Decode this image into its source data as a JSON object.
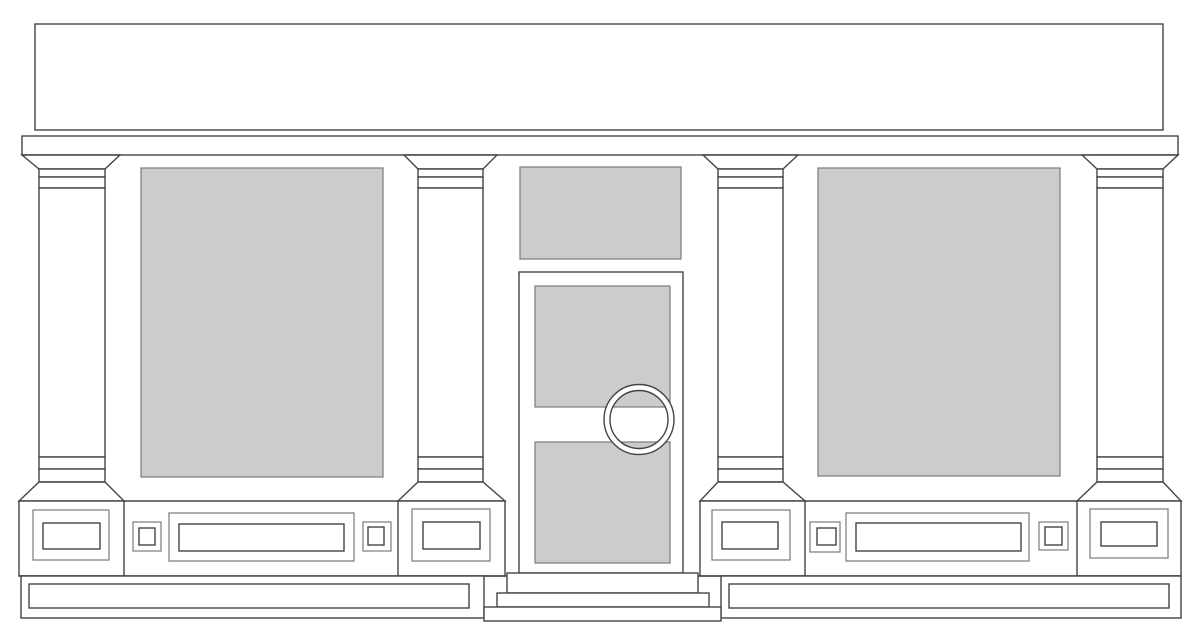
{
  "meta": {
    "canvas": {
      "w": 1200,
      "h": 639
    }
  },
  "palette": {
    "background": "#ffffff",
    "surface": "#ffffff",
    "glass": "#cccccc",
    "stroke_dark": "#454545",
    "stroke_mid": "#7f7f7f"
  },
  "drawing": {
    "shapes": [
      {
        "name": "fascia-signboard",
        "type": "rect",
        "x": 35,
        "y": 24,
        "w": 1128,
        "h": 106,
        "fill": "surface",
        "stroke": "dark"
      },
      {
        "name": "cornice",
        "type": "rect",
        "x": 22,
        "y": 136,
        "w": 1156,
        "h": 19,
        "fill": "surface",
        "stroke": "dark"
      },
      {
        "name": "pilaster-1-capital-flare",
        "type": "poly",
        "pts": [
          [
            22,
            155
          ],
          [
            120,
            155
          ],
          [
            105,
            169
          ],
          [
            39,
            169
          ]
        ],
        "fill": "surface",
        "stroke": "dark"
      },
      {
        "name": "pilaster-1-capital-band-top",
        "type": "rect",
        "x": 39,
        "y": 169,
        "w": 66,
        "h": 8,
        "fill": "surface",
        "stroke": "dark"
      },
      {
        "name": "pilaster-1-capital-band-bottom",
        "type": "rect",
        "x": 39,
        "y": 177,
        "w": 66,
        "h": 11,
        "fill": "surface",
        "stroke": "dark"
      },
      {
        "name": "pilaster-1-shaft",
        "type": "rect",
        "x": 39,
        "y": 188,
        "w": 66,
        "h": 269,
        "fill": "surface",
        "stroke": "dark"
      },
      {
        "name": "pilaster-1-base-band-top",
        "type": "rect",
        "x": 39,
        "y": 457,
        "w": 66,
        "h": 12,
        "fill": "surface",
        "stroke": "dark"
      },
      {
        "name": "pilaster-1-base-band-bottom",
        "type": "rect",
        "x": 39,
        "y": 469,
        "w": 66,
        "h": 13,
        "fill": "surface",
        "stroke": "dark"
      },
      {
        "name": "pilaster-1-base-flare",
        "type": "poly",
        "pts": [
          [
            39,
            482
          ],
          [
            105,
            482
          ],
          [
            124,
            501
          ],
          [
            19,
            501
          ]
        ],
        "fill": "surface",
        "stroke": "dark"
      },
      {
        "name": "pilaster-1-plinth",
        "type": "rect",
        "x": 19,
        "y": 501,
        "w": 105,
        "h": 75,
        "fill": "surface",
        "stroke": "dark"
      },
      {
        "name": "pilaster-1-plinth-panel-outer",
        "type": "rect",
        "x": 33,
        "y": 510,
        "w": 76,
        "h": 50,
        "fill": "none",
        "stroke": "mid"
      },
      {
        "name": "pilaster-1-plinth-panel-inner",
        "type": "rect",
        "x": 43,
        "y": 523,
        "w": 57,
        "h": 26,
        "fill": "none",
        "stroke": "dark"
      },
      {
        "name": "pilaster-2-capital-flare",
        "type": "poly",
        "pts": [
          [
            404,
            155
          ],
          [
            497,
            155
          ],
          [
            483,
            169
          ],
          [
            418,
            169
          ]
        ],
        "fill": "surface",
        "stroke": "dark"
      },
      {
        "name": "pilaster-2-capital-band-top",
        "type": "rect",
        "x": 418,
        "y": 169,
        "w": 65,
        "h": 8,
        "fill": "surface",
        "stroke": "dark"
      },
      {
        "name": "pilaster-2-capital-band-bottom",
        "type": "rect",
        "x": 418,
        "y": 177,
        "w": 65,
        "h": 11,
        "fill": "surface",
        "stroke": "dark"
      },
      {
        "name": "pilaster-2-shaft",
        "type": "rect",
        "x": 418,
        "y": 188,
        "w": 65,
        "h": 269,
        "fill": "surface",
        "stroke": "dark"
      },
      {
        "name": "pilaster-2-base-band-top",
        "type": "rect",
        "x": 418,
        "y": 457,
        "w": 65,
        "h": 12,
        "fill": "surface",
        "stroke": "dark"
      },
      {
        "name": "pilaster-2-base-band-bottom",
        "type": "rect",
        "x": 418,
        "y": 469,
        "w": 65,
        "h": 13,
        "fill": "surface",
        "stroke": "dark"
      },
      {
        "name": "pilaster-2-base-flare",
        "type": "poly",
        "pts": [
          [
            418,
            482
          ],
          [
            483,
            482
          ],
          [
            505,
            501
          ],
          [
            398,
            501
          ]
        ],
        "fill": "surface",
        "stroke": "dark"
      },
      {
        "name": "pilaster-2-plinth",
        "type": "rect",
        "x": 398,
        "y": 501,
        "w": 107,
        "h": 75,
        "fill": "surface",
        "stroke": "dark"
      },
      {
        "name": "pilaster-2-plinth-panel-outer",
        "type": "rect",
        "x": 412,
        "y": 509,
        "w": 78,
        "h": 52,
        "fill": "none",
        "stroke": "mid"
      },
      {
        "name": "pilaster-2-plinth-panel-inner",
        "type": "rect",
        "x": 423,
        "y": 522,
        "w": 57,
        "h": 27,
        "fill": "none",
        "stroke": "dark"
      },
      {
        "name": "pilaster-3-capital-flare",
        "type": "poly",
        "pts": [
          [
            703,
            155
          ],
          [
            798,
            155
          ],
          [
            783,
            169
          ],
          [
            718,
            169
          ]
        ],
        "fill": "surface",
        "stroke": "dark"
      },
      {
        "name": "pilaster-3-capital-band-top",
        "type": "rect",
        "x": 718,
        "y": 169,
        "w": 65,
        "h": 8,
        "fill": "surface",
        "stroke": "dark"
      },
      {
        "name": "pilaster-3-capital-band-bottom",
        "type": "rect",
        "x": 718,
        "y": 177,
        "w": 65,
        "h": 11,
        "fill": "surface",
        "stroke": "dark"
      },
      {
        "name": "pilaster-3-shaft",
        "type": "rect",
        "x": 718,
        "y": 188,
        "w": 65,
        "h": 269,
        "fill": "surface",
        "stroke": "dark"
      },
      {
        "name": "pilaster-3-base-band-top",
        "type": "rect",
        "x": 718,
        "y": 457,
        "w": 65,
        "h": 12,
        "fill": "surface",
        "stroke": "dark"
      },
      {
        "name": "pilaster-3-base-band-bottom",
        "type": "rect",
        "x": 718,
        "y": 469,
        "w": 65,
        "h": 13,
        "fill": "surface",
        "stroke": "dark"
      },
      {
        "name": "pilaster-3-base-flare",
        "type": "poly",
        "pts": [
          [
            718,
            482
          ],
          [
            783,
            482
          ],
          [
            805,
            501
          ],
          [
            700,
            501
          ]
        ],
        "fill": "surface",
        "stroke": "dark"
      },
      {
        "name": "pilaster-3-plinth",
        "type": "rect",
        "x": 700,
        "y": 501,
        "w": 105,
        "h": 75,
        "fill": "surface",
        "stroke": "dark"
      },
      {
        "name": "pilaster-3-plinth-panel-outer",
        "type": "rect",
        "x": 712,
        "y": 510,
        "w": 78,
        "h": 50,
        "fill": "none",
        "stroke": "mid"
      },
      {
        "name": "pilaster-3-plinth-panel-inner",
        "type": "rect",
        "x": 722,
        "y": 522,
        "w": 56,
        "h": 27,
        "fill": "none",
        "stroke": "dark"
      },
      {
        "name": "pilaster-4-capital-flare",
        "type": "poly",
        "pts": [
          [
            1082,
            155
          ],
          [
            1178,
            155
          ],
          [
            1163,
            169
          ],
          [
            1097,
            169
          ]
        ],
        "fill": "surface",
        "stroke": "dark"
      },
      {
        "name": "pilaster-4-capital-band-top",
        "type": "rect",
        "x": 1097,
        "y": 169,
        "w": 66,
        "h": 8,
        "fill": "surface",
        "stroke": "dark"
      },
      {
        "name": "pilaster-4-capital-band-bottom",
        "type": "rect",
        "x": 1097,
        "y": 177,
        "w": 66,
        "h": 11,
        "fill": "surface",
        "stroke": "dark"
      },
      {
        "name": "pilaster-4-shaft",
        "type": "rect",
        "x": 1097,
        "y": 188,
        "w": 66,
        "h": 269,
        "fill": "surface",
        "stroke": "dark"
      },
      {
        "name": "pilaster-4-base-band-top",
        "type": "rect",
        "x": 1097,
        "y": 457,
        "w": 66,
        "h": 12,
        "fill": "surface",
        "stroke": "dark"
      },
      {
        "name": "pilaster-4-base-band-bottom",
        "type": "rect",
        "x": 1097,
        "y": 469,
        "w": 66,
        "h": 13,
        "fill": "surface",
        "stroke": "dark"
      },
      {
        "name": "pilaster-4-base-flare",
        "type": "poly",
        "pts": [
          [
            1097,
            482
          ],
          [
            1163,
            482
          ],
          [
            1181,
            501
          ],
          [
            1077,
            501
          ]
        ],
        "fill": "surface",
        "stroke": "dark"
      },
      {
        "name": "pilaster-4-plinth",
        "type": "rect",
        "x": 1077,
        "y": 501,
        "w": 104,
        "h": 75,
        "fill": "surface",
        "stroke": "dark"
      },
      {
        "name": "pilaster-4-plinth-panel-outer",
        "type": "rect",
        "x": 1090,
        "y": 509,
        "w": 78,
        "h": 49,
        "fill": "none",
        "stroke": "mid"
      },
      {
        "name": "pilaster-4-plinth-panel-inner",
        "type": "rect",
        "x": 1101,
        "y": 522,
        "w": 56,
        "h": 24,
        "fill": "none",
        "stroke": "dark"
      },
      {
        "name": "stallriser-top-edge-left",
        "type": "line",
        "x1": 124,
        "y1": 501,
        "x2": 398,
        "y2": 501,
        "stroke": "dark"
      },
      {
        "name": "stallriser-top-edge-right",
        "type": "line",
        "x1": 805,
        "y1": 501,
        "x2": 1077,
        "y2": 501,
        "stroke": "dark"
      },
      {
        "name": "ground-line",
        "type": "line",
        "x1": 19,
        "y1": 576,
        "x2": 1181,
        "y2": 576,
        "stroke": "dark"
      },
      {
        "name": "left-display-window-glass",
        "type": "rect",
        "x": 141,
        "y": 168,
        "w": 242,
        "h": 309,
        "fill": "glass",
        "stroke": "mid"
      },
      {
        "name": "right-display-window-glass",
        "type": "rect",
        "x": 818,
        "y": 168,
        "w": 242,
        "h": 308,
        "fill": "glass",
        "stroke": "mid"
      },
      {
        "name": "stallriser-left-square-panel-a-outer",
        "type": "rect",
        "x": 133,
        "y": 522,
        "w": 28,
        "h": 29,
        "fill": "none",
        "stroke": "mid"
      },
      {
        "name": "stallriser-left-square-panel-a-inner",
        "type": "rect",
        "x": 139,
        "y": 528,
        "w": 16,
        "h": 17,
        "fill": "none",
        "stroke": "dark"
      },
      {
        "name": "stallriser-left-long-panel-outer",
        "type": "rect",
        "x": 169,
        "y": 513,
        "w": 185,
        "h": 48,
        "fill": "none",
        "stroke": "mid"
      },
      {
        "name": "stallriser-left-long-panel-inner",
        "type": "rect",
        "x": 179,
        "y": 524,
        "w": 165,
        "h": 27,
        "fill": "none",
        "stroke": "dark"
      },
      {
        "name": "stallriser-left-square-panel-b-outer",
        "type": "rect",
        "x": 363,
        "y": 522,
        "w": 28,
        "h": 29,
        "fill": "none",
        "stroke": "mid"
      },
      {
        "name": "stallriser-left-square-panel-b-inner",
        "type": "rect",
        "x": 368,
        "y": 527,
        "w": 16,
        "h": 18,
        "fill": "none",
        "stroke": "dark"
      },
      {
        "name": "stallriser-right-square-panel-c-outer",
        "type": "rect",
        "x": 810,
        "y": 522,
        "w": 30,
        "h": 30,
        "fill": "none",
        "stroke": "mid"
      },
      {
        "name": "stallriser-right-square-panel-c-inner",
        "type": "rect",
        "x": 817,
        "y": 528,
        "w": 19,
        "h": 17,
        "fill": "none",
        "stroke": "dark"
      },
      {
        "name": "stallriser-right-long-panel-outer",
        "type": "rect",
        "x": 846,
        "y": 513,
        "w": 183,
        "h": 48,
        "fill": "none",
        "stroke": "mid"
      },
      {
        "name": "stallriser-right-long-panel-inner",
        "type": "rect",
        "x": 856,
        "y": 523,
        "w": 165,
        "h": 28,
        "fill": "none",
        "stroke": "dark"
      },
      {
        "name": "stallriser-right-square-panel-d-outer",
        "type": "rect",
        "x": 1039,
        "y": 522,
        "w": 29,
        "h": 28,
        "fill": "none",
        "stroke": "mid"
      },
      {
        "name": "stallriser-right-square-panel-d-inner",
        "type": "rect",
        "x": 1045,
        "y": 527,
        "w": 17,
        "h": 18,
        "fill": "none",
        "stroke": "dark"
      },
      {
        "name": "transom-glass",
        "type": "rect",
        "x": 520,
        "y": 167,
        "w": 161,
        "h": 92,
        "fill": "glass",
        "stroke": "mid"
      },
      {
        "name": "door-frame",
        "type": "rect",
        "x": 519,
        "y": 272,
        "w": 164,
        "h": 301,
        "fill": "surface",
        "stroke": "dark"
      },
      {
        "name": "door-glass-upper",
        "type": "rect",
        "x": 535,
        "y": 286,
        "w": 135,
        "h": 121,
        "fill": "glass",
        "stroke": "mid"
      },
      {
        "name": "door-glass-lower",
        "type": "rect",
        "x": 535,
        "y": 442,
        "w": 135,
        "h": 121,
        "fill": "glass",
        "stroke": "mid"
      },
      {
        "name": "baseboard-left-outer",
        "type": "rect",
        "x": 21,
        "y": 576,
        "w": 463,
        "h": 42,
        "fill": "surface",
        "stroke": "dark"
      },
      {
        "name": "baseboard-left-inner",
        "type": "rect",
        "x": 29,
        "y": 584,
        "w": 440,
        "h": 24,
        "fill": "none",
        "stroke": "dark"
      },
      {
        "name": "baseboard-right-outer",
        "type": "rect",
        "x": 721,
        "y": 576,
        "w": 460,
        "h": 42,
        "fill": "surface",
        "stroke": "dark"
      },
      {
        "name": "baseboard-right-inner",
        "type": "rect",
        "x": 729,
        "y": 584,
        "w": 440,
        "h": 24,
        "fill": "none",
        "stroke": "dark"
      },
      {
        "name": "door-step-top",
        "type": "rect",
        "x": 507,
        "y": 573,
        "w": 191,
        "h": 20,
        "fill": "surface",
        "stroke": "dark"
      },
      {
        "name": "door-step-middle",
        "type": "rect",
        "x": 497,
        "y": 593,
        "w": 212,
        "h": 14,
        "fill": "surface",
        "stroke": "dark"
      },
      {
        "name": "door-step-bottom",
        "type": "rect",
        "x": 484,
        "y": 607,
        "w": 237,
        "h": 14,
        "fill": "surface",
        "stroke": "dark"
      },
      {
        "name": "door-handle-ring",
        "type": "ring",
        "cx": 639,
        "cy": 419.5,
        "ro": 35,
        "ri": 29,
        "fill": "surface",
        "stroke": "dark"
      }
    ]
  }
}
